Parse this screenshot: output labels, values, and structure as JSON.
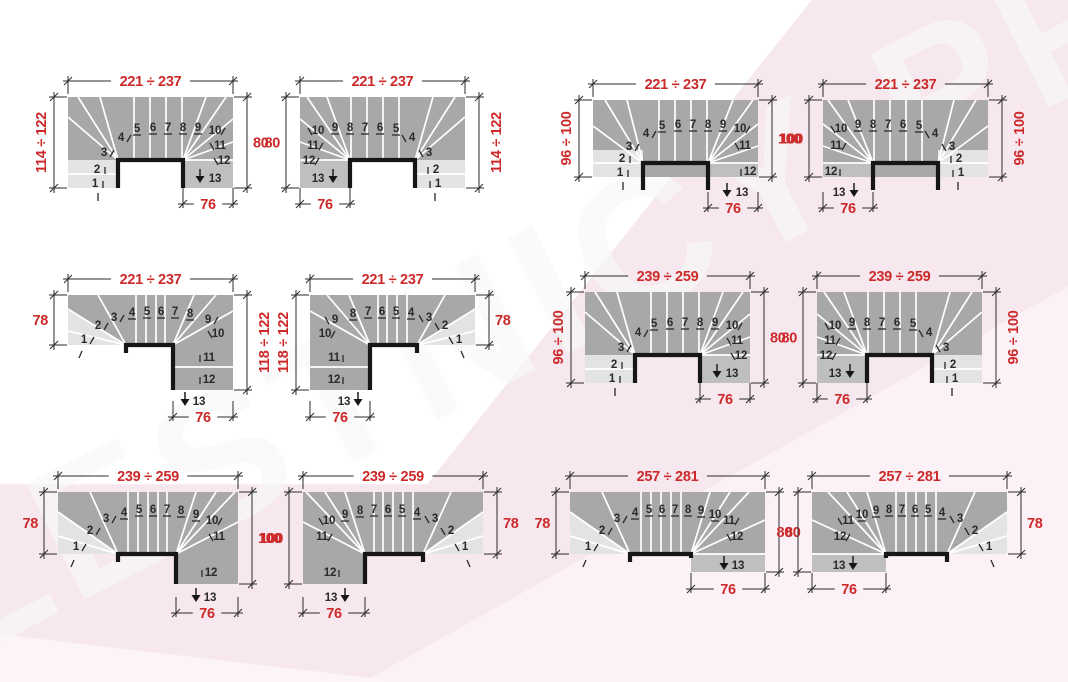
{
  "watermark": {
    "text": "LESTNICY-PROSTO.RU"
  },
  "colors": {
    "dim_red": "#cc2a2a",
    "num_black": "#2a2a2a",
    "dim_line": "#2b2b2b",
    "step_line": "#ffffff",
    "tread_gray": "#a8a8aa",
    "entry_gray": "#e3e3e4",
    "exit_gray": "#bfbfc1",
    "well_edge": "#161616",
    "bg_pink": "#f7e7ee",
    "bg_pink_light": "#fbf2f7"
  },
  "step_numbers": [
    "1",
    "2",
    "3",
    "4",
    "5",
    "6",
    "7",
    "8",
    "9",
    "10",
    "11",
    "12",
    "13"
  ],
  "diagrams": [
    {
      "id": "d1",
      "shape": {
        "type": "UIN",
        "mirror": false
      },
      "x": 18,
      "y": 67,
      "dims": {
        "top": "221 ÷ 237",
        "left": {
          "text": "114 ÷ 122",
          "rotated": true
        },
        "right": {
          "text": "80",
          "rotated": false
        },
        "bottom": "76"
      }
    },
    {
      "id": "d2",
      "shape": {
        "type": "UIN",
        "mirror": true
      },
      "x": 250,
      "y": 67,
      "dims": {
        "top": "221 ÷ 237",
        "left": {
          "text": "80",
          "rotated": false
        },
        "right": {
          "text": "114 ÷ 122",
          "rotated": true
        },
        "bottom": "76"
      }
    },
    {
      "id": "d3",
      "shape": {
        "type": "UOUT",
        "mirror": false
      },
      "x": 543,
      "y": 70,
      "dims": {
        "top": "221 ÷ 237",
        "left": {
          "text": "96 ÷ 100",
          "rotated": true
        },
        "right": {
          "text": "100",
          "rotated": false
        },
        "bottom": "76"
      }
    },
    {
      "id": "d4",
      "shape": {
        "type": "UOUT",
        "mirror": true
      },
      "x": 773,
      "y": 70,
      "dims": {
        "top": "221 ÷ 237",
        "left": {
          "text": "100",
          "rotated": false
        },
        "right": {
          "text": "96 ÷ 100",
          "rotated": true
        },
        "bottom": "76"
      }
    },
    {
      "id": "d5",
      "shape": {
        "type": "LLONG",
        "mirror": false
      },
      "x": 18,
      "y": 265,
      "dims": {
        "top": "221 ÷ 237",
        "left": {
          "text": "78",
          "rotated": false
        },
        "right": {
          "text": "118 ÷ 122",
          "rotated": true
        },
        "bottom": "76"
      }
    },
    {
      "id": "d6",
      "shape": {
        "type": "LLONG",
        "mirror": true
      },
      "x": 260,
      "y": 265,
      "dims": {
        "top": "221 ÷ 237",
        "left": {
          "text": "118 ÷ 122",
          "rotated": true
        },
        "right": {
          "text": "78",
          "rotated": false
        },
        "bottom": "76"
      }
    },
    {
      "id": "d7",
      "shape": {
        "type": "UIN",
        "mirror": false
      },
      "x": 535,
      "y": 262,
      "dims": {
        "top": "239 ÷ 259",
        "left": {
          "text": "96 ÷ 100",
          "rotated": true
        },
        "right": {
          "text": "80",
          "rotated": false
        },
        "bottom": "76"
      }
    },
    {
      "id": "d8",
      "shape": {
        "type": "UIN",
        "mirror": true
      },
      "x": 767,
      "y": 262,
      "dims": {
        "top": "239 ÷ 259",
        "left": {
          "text": "80",
          "rotated": false
        },
        "right": {
          "text": "96 ÷ 100",
          "rotated": true
        },
        "bottom": "76"
      }
    },
    {
      "id": "d9",
      "shape": {
        "type": "LSHORT",
        "mirror": false
      },
      "x": 8,
      "y": 462,
      "dims": {
        "top": "239 ÷ 259",
        "left": {
          "text": "78",
          "rotated": false
        },
        "right": {
          "text": "100",
          "rotated": false
        },
        "bottom": "76"
      }
    },
    {
      "id": "d10",
      "shape": {
        "type": "LSHORT",
        "mirror": true
      },
      "x": 253,
      "y": 462,
      "dims": {
        "top": "239 ÷ 259",
        "left": {
          "text": "100",
          "rotated": false
        },
        "right": {
          "text": "78",
          "rotated": false
        },
        "bottom": "76"
      }
    },
    {
      "id": "d11",
      "shape": {
        "type": "REXT",
        "mirror": false
      },
      "x": 520,
      "y": 462,
      "dims": {
        "top": "257 ÷ 281",
        "left": {
          "text": "78",
          "rotated": false
        },
        "right": {
          "text": "80",
          "rotated": false
        },
        "bottom": "76"
      }
    },
    {
      "id": "d12",
      "shape": {
        "type": "REXT",
        "mirror": true
      },
      "x": 762,
      "y": 462,
      "dims": {
        "top": "257 ÷ 281",
        "left": {
          "text": "80",
          "rotated": false
        },
        "right": {
          "text": "78",
          "rotated": false
        },
        "bottom": "76"
      }
    }
  ]
}
